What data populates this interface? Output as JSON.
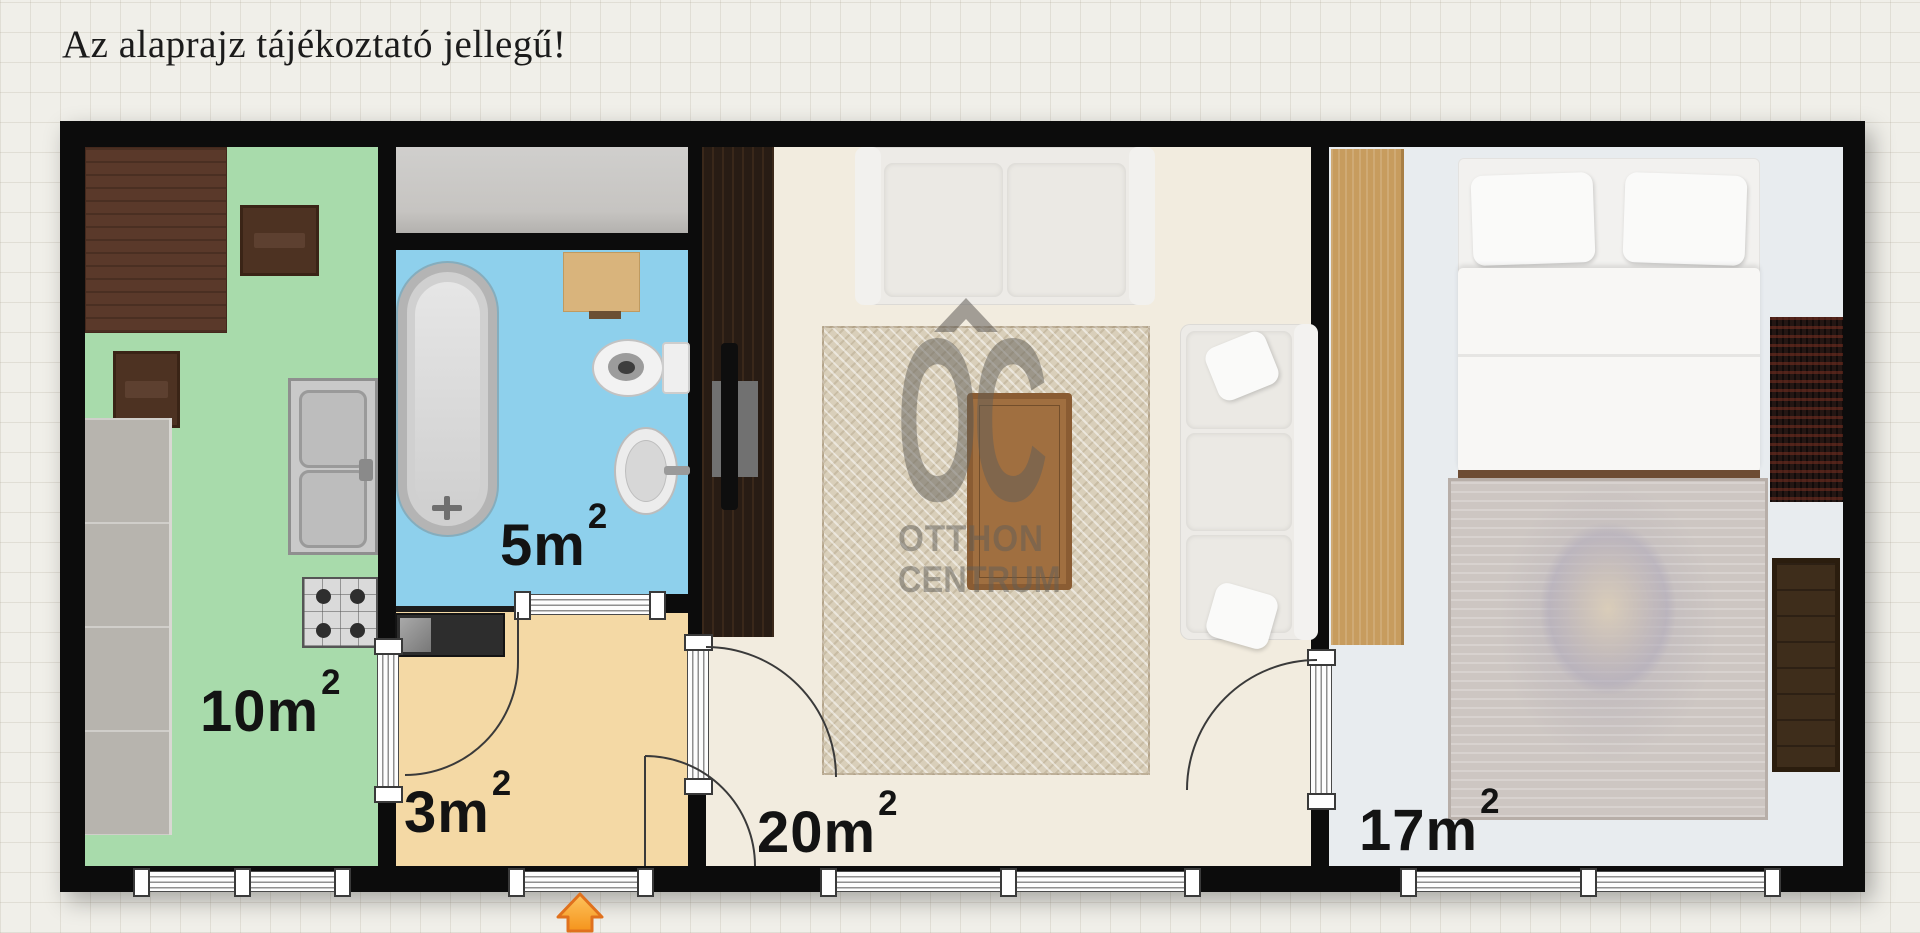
{
  "disclaimer": "Az alaprajz tájékoztató jellegű!",
  "watermark": {
    "initials": "OC",
    "line1": "OTTHON",
    "line2": "CENTRUM"
  },
  "rooms": [
    {
      "name": "kitchen",
      "area": "10m",
      "sup": "2",
      "color": "#a8dbab"
    },
    {
      "name": "bathroom",
      "area": "5m",
      "sup": "2",
      "color": "#8ed0ec"
    },
    {
      "name": "hallway",
      "area": "3m",
      "sup": "2",
      "color": "#f4d9a5"
    },
    {
      "name": "living_room",
      "area": "20m",
      "sup": "2",
      "color": "#f2ecdf"
    },
    {
      "name": "bedroom",
      "area": "17m",
      "sup": "2",
      "color": "#e8ecef"
    }
  ],
  "colors": {
    "paper": "#f0efe9",
    "wall": "#0c0c0c",
    "kitchen": "#a8dbab",
    "bathroom": "#8ed0ec",
    "hallway": "#f4d9a5",
    "living": "#f2ecdf",
    "bedroom": "#e8ecef",
    "closet": "#c9c8c5",
    "arrow_fill": "#f9a93c",
    "arrow_border": "#e0711d"
  }
}
